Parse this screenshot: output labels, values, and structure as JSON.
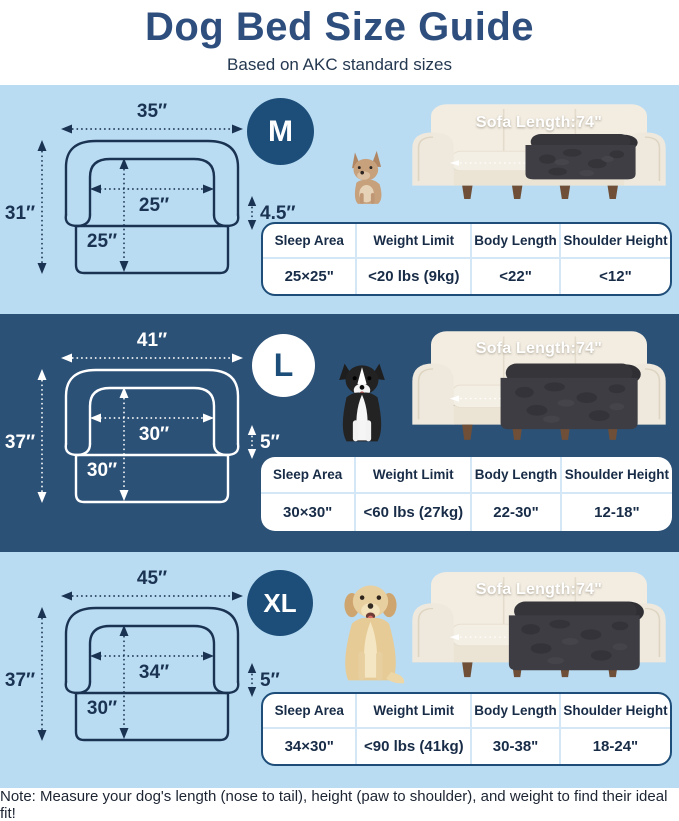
{
  "header": {
    "title": "Dog Bed Size Guide",
    "subtitle": "Based on AKC standard sizes"
  },
  "table_headers": {
    "sleep_area": "Sleep Area",
    "weight_limit": "Weight Limit",
    "body_length": "Body Length",
    "shoulder_height": "Shoulder Height"
  },
  "sections": [
    {
      "badge": "M",
      "dog": "french-bulldog",
      "sofa_label": "Sofa Length:74\"",
      "dimensions": {
        "outer_width": "35″",
        "outer_height": "31″",
        "inner_width": "25″",
        "inner_height": "25″",
        "arm_height": "4.5″"
      },
      "specs": {
        "sleep_area": "25×25\"",
        "weight_limit": "<20 lbs (9kg)",
        "body_length": "<22\"",
        "shoulder_height": "<12\""
      }
    },
    {
      "badge": "L",
      "dog": "border-collie",
      "sofa_label": "Sofa Length:74\"",
      "dimensions": {
        "outer_width": "41″",
        "outer_height": "37″",
        "inner_width": "30″",
        "inner_height": "30″",
        "arm_height": "5″"
      },
      "specs": {
        "sleep_area": "30×30\"",
        "weight_limit": "<60 lbs (27kg)",
        "body_length": "22-30\"",
        "shoulder_height": "12-18\""
      }
    },
    {
      "badge": "XL",
      "dog": "golden-retriever",
      "sofa_label": "Sofa Length:74\"",
      "dimensions": {
        "outer_width": "45″",
        "outer_height": "37″",
        "inner_width": "34″",
        "inner_height": "30″",
        "arm_height": "5″"
      },
      "specs": {
        "sleep_area": "34×30\"",
        "weight_limit": "<90 lbs (41kg)",
        "body_length": "30-38\"",
        "shoulder_height": "18-24\""
      }
    }
  ],
  "footer": {
    "note": "Note: Measure your dog's length (nose to tail), height (paw to shoulder), and weight to find their ideal fit!"
  },
  "colors": {
    "navy": "#1d4e79",
    "title_navy": "#2e4e7e",
    "light_blue_bg": "#b9dcf3",
    "dark_blue_bg": "#2c5177",
    "table_divider": "#d3e7f6",
    "bed_cover_gray": "#3d3d43",
    "sofa_cream": "#f2ece1"
  }
}
